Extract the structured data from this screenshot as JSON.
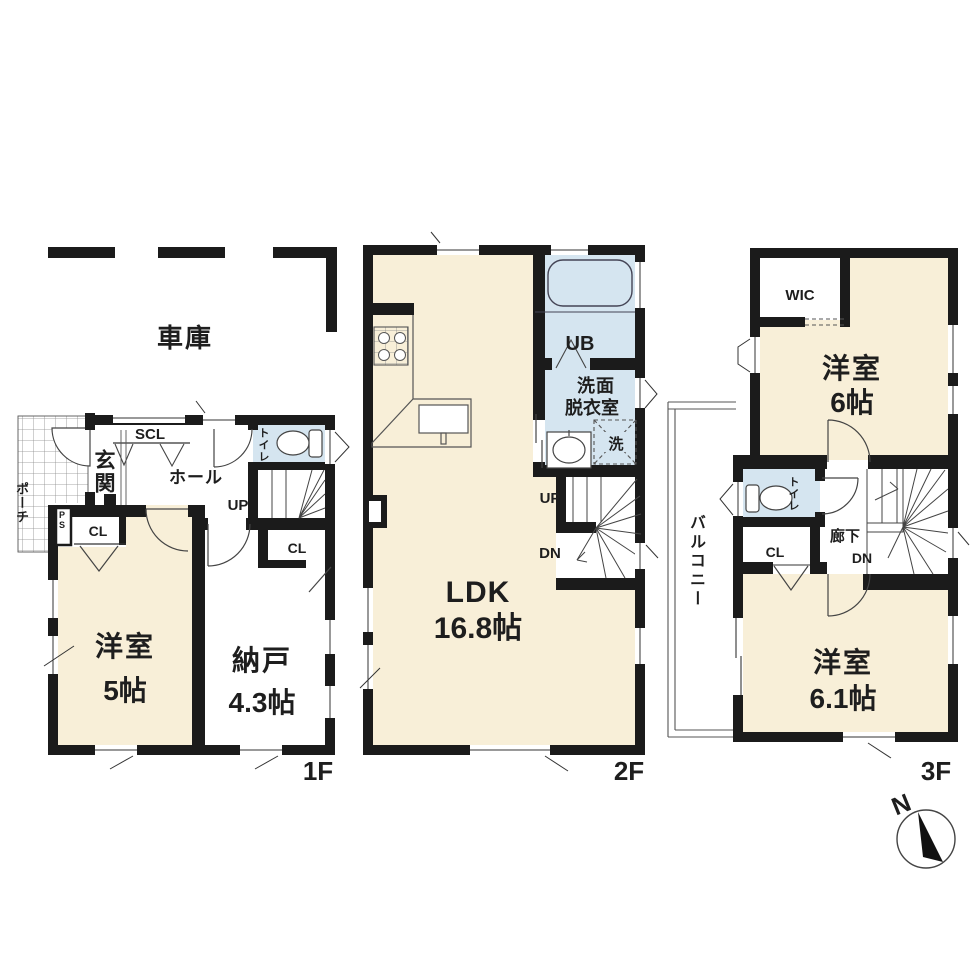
{
  "colors": {
    "cream": "#f8efd8",
    "blue": "#d5e5f0",
    "wall": "#1b1b1b",
    "line": "#3c3c3c",
    "white": "#ffffff"
  },
  "f1": {
    "floor": "1F",
    "garage": "車庫",
    "porch": "ポーチ",
    "entrance": "玄関",
    "shoe_closet": "SCL",
    "hall": "ホール",
    "toilet": "トイレ",
    "stairs_up": "UP",
    "pipe_space": "PS",
    "closet_a": "CL",
    "bedroom": "洋室",
    "bedroom_size": "5帖",
    "storage": "納戸",
    "storage_size": "4.3帖",
    "closet_b": "CL"
  },
  "f2": {
    "floor": "2F",
    "ldk": "LDK",
    "ldk_size": "16.8帖",
    "unit_bath": "UB",
    "washroom_line1": "洗面",
    "washroom_line2": "脱衣室",
    "laundry": "洗",
    "stairs_up": "UP",
    "stairs_dn": "DN"
  },
  "f3": {
    "floor": "3F",
    "wic": "WIC",
    "bedroom6": "洋室",
    "bedroom6_size": "6帖",
    "toilet": "トイレ",
    "closet": "CL",
    "corridor": "廊下",
    "stairs_dn": "DN",
    "balcony": "バルコニー",
    "bedroom61": "洋室",
    "bedroom61_size": "6.1帖"
  },
  "compass": {
    "north": "N"
  }
}
